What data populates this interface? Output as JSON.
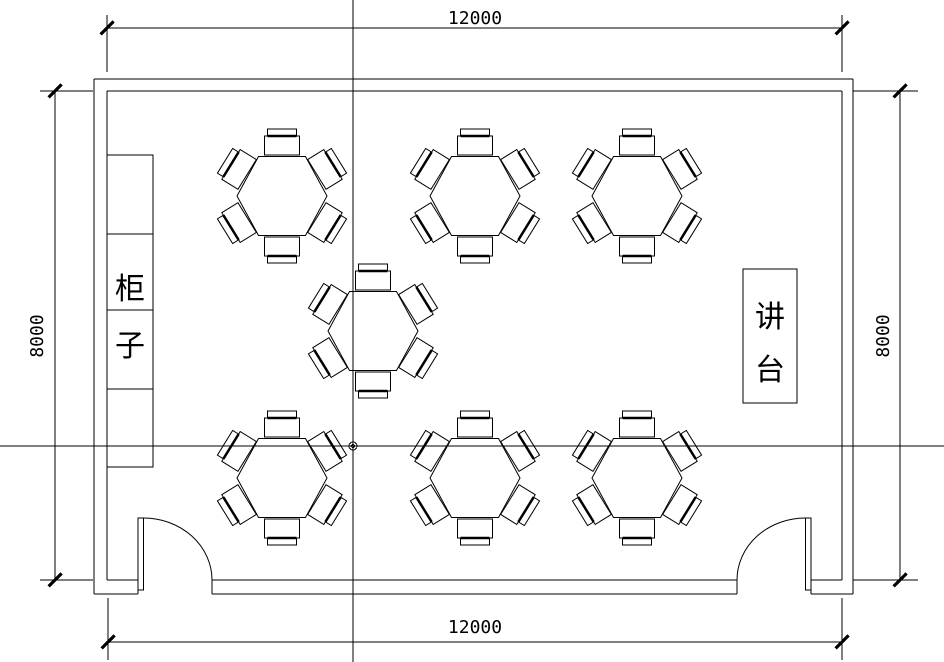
{
  "drawing": {
    "type": "classroom-floor-plan",
    "background_color": "#ffffff",
    "line_color": "#000000",
    "dimensions": {
      "top": "12000",
      "bottom": "12000",
      "left": "8000",
      "right": "8000"
    },
    "labels": {
      "cabinet": "柜子",
      "podium": "讲台"
    },
    "tables": [
      {
        "x": 282,
        "y": 196
      },
      {
        "x": 475,
        "y": 196
      },
      {
        "x": 637,
        "y": 196
      },
      {
        "x": 373,
        "y": 331
      },
      {
        "x": 282,
        "y": 478
      },
      {
        "x": 475,
        "y": 478
      },
      {
        "x": 637,
        "y": 478
      }
    ],
    "seats_per_table": 6,
    "doors": 2
  }
}
